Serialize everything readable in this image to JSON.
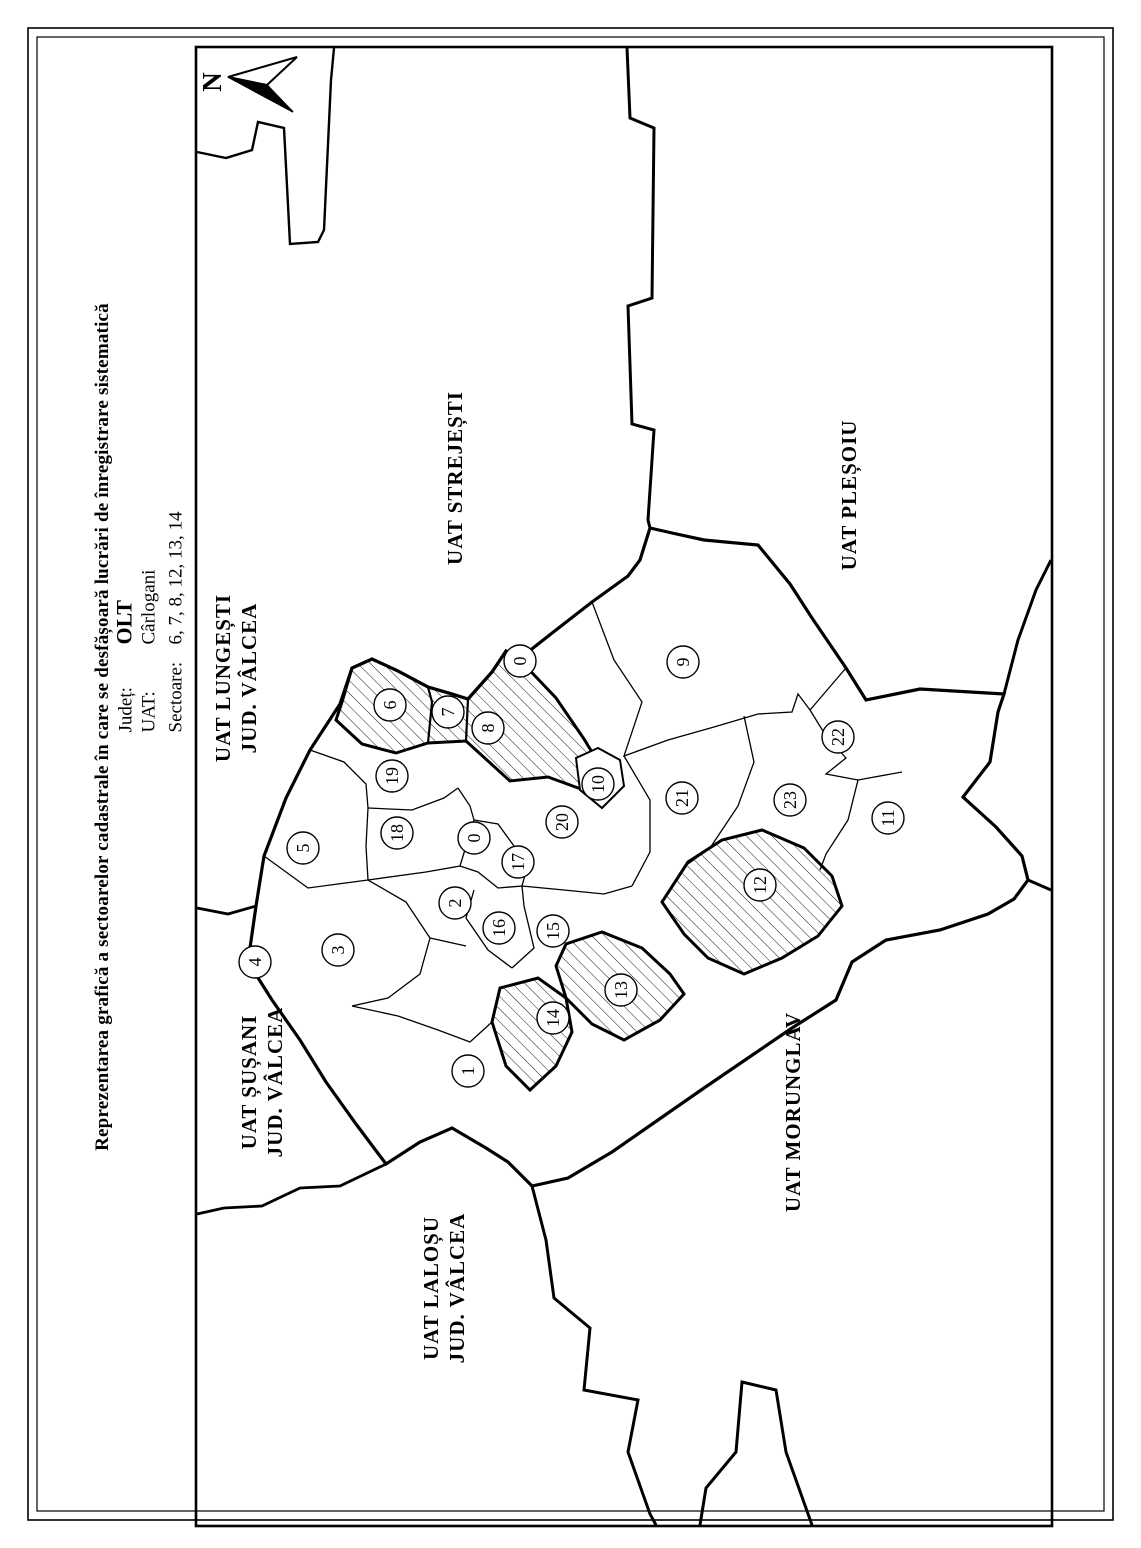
{
  "document": {
    "title": "Reprezentarea grafică a sectoarelor cadastrale în care se desfășoară lucrări de înregistrare sistematică",
    "fields": [
      {
        "label": "Județ:",
        "value": "OLT",
        "emphasized": true
      },
      {
        "label": "UAT:",
        "value": "Cârlogani",
        "emphasized": false
      },
      {
        "label": "Sectoare:",
        "value": "6, 7, 8, 12, 13, 14",
        "emphasized": false
      }
    ]
  },
  "map": {
    "north_label": "N",
    "colors": {
      "line": "#000000",
      "background": "#ffffff"
    },
    "hatched_sector_labels": [
      "6",
      "7",
      "8",
      "12",
      "13",
      "14"
    ],
    "neighbors": [
      {
        "id": "uat-strejesti",
        "lines": [
          "UAT STREJEȘTI"
        ],
        "x": 455,
        "y": 478
      },
      {
        "id": "uat-plesoiu",
        "lines": [
          "UAT PLEȘOIU"
        ],
        "x": 849,
        "y": 495
      },
      {
        "id": "uat-lungesti",
        "lines": [
          "UAT LUNGEȘTI",
          "JUD. VÂLCEA"
        ],
        "x": 236,
        "y": 678
      },
      {
        "id": "uat-susani",
        "lines": [
          "UAT ȘUȘANI",
          "JUD. VÂLCEA"
        ],
        "x": 262,
        "y": 1082
      },
      {
        "id": "uat-lalosu",
        "lines": [
          "UAT LALOȘU",
          "JUD. VÂLCEA"
        ],
        "x": 444,
        "y": 1288
      },
      {
        "id": "uat-morunglav",
        "lines": [
          "UAT MORUNGLAV"
        ],
        "x": 793,
        "y": 1112
      }
    ],
    "sectors": [
      {
        "label": "0",
        "x": 520,
        "y": 661
      },
      {
        "label": "6",
        "x": 390,
        "y": 705
      },
      {
        "label": "7",
        "x": 448,
        "y": 712
      },
      {
        "label": "8",
        "x": 488,
        "y": 728
      },
      {
        "label": "9",
        "x": 683,
        "y": 662
      },
      {
        "label": "19",
        "x": 392,
        "y": 776
      },
      {
        "label": "18",
        "x": 397,
        "y": 833
      },
      {
        "label": "0",
        "x": 474,
        "y": 838
      },
      {
        "label": "10",
        "x": 598,
        "y": 784
      },
      {
        "label": "20",
        "x": 562,
        "y": 822
      },
      {
        "label": "17",
        "x": 518,
        "y": 862
      },
      {
        "label": "21",
        "x": 682,
        "y": 798
      },
      {
        "label": "22",
        "x": 838,
        "y": 737
      },
      {
        "label": "23",
        "x": 790,
        "y": 800
      },
      {
        "label": "11",
        "x": 888,
        "y": 818
      },
      {
        "label": "12",
        "x": 760,
        "y": 885
      },
      {
        "label": "5",
        "x": 303,
        "y": 848
      },
      {
        "label": "2",
        "x": 455,
        "y": 903
      },
      {
        "label": "3",
        "x": 338,
        "y": 950
      },
      {
        "label": "4",
        "x": 255,
        "y": 962
      },
      {
        "label": "16",
        "x": 499,
        "y": 928
      },
      {
        "label": "15",
        "x": 553,
        "y": 931
      },
      {
        "label": "13",
        "x": 621,
        "y": 990
      },
      {
        "label": "14",
        "x": 553,
        "y": 1018
      },
      {
        "label": "1",
        "x": 468,
        "y": 1071
      }
    ]
  }
}
